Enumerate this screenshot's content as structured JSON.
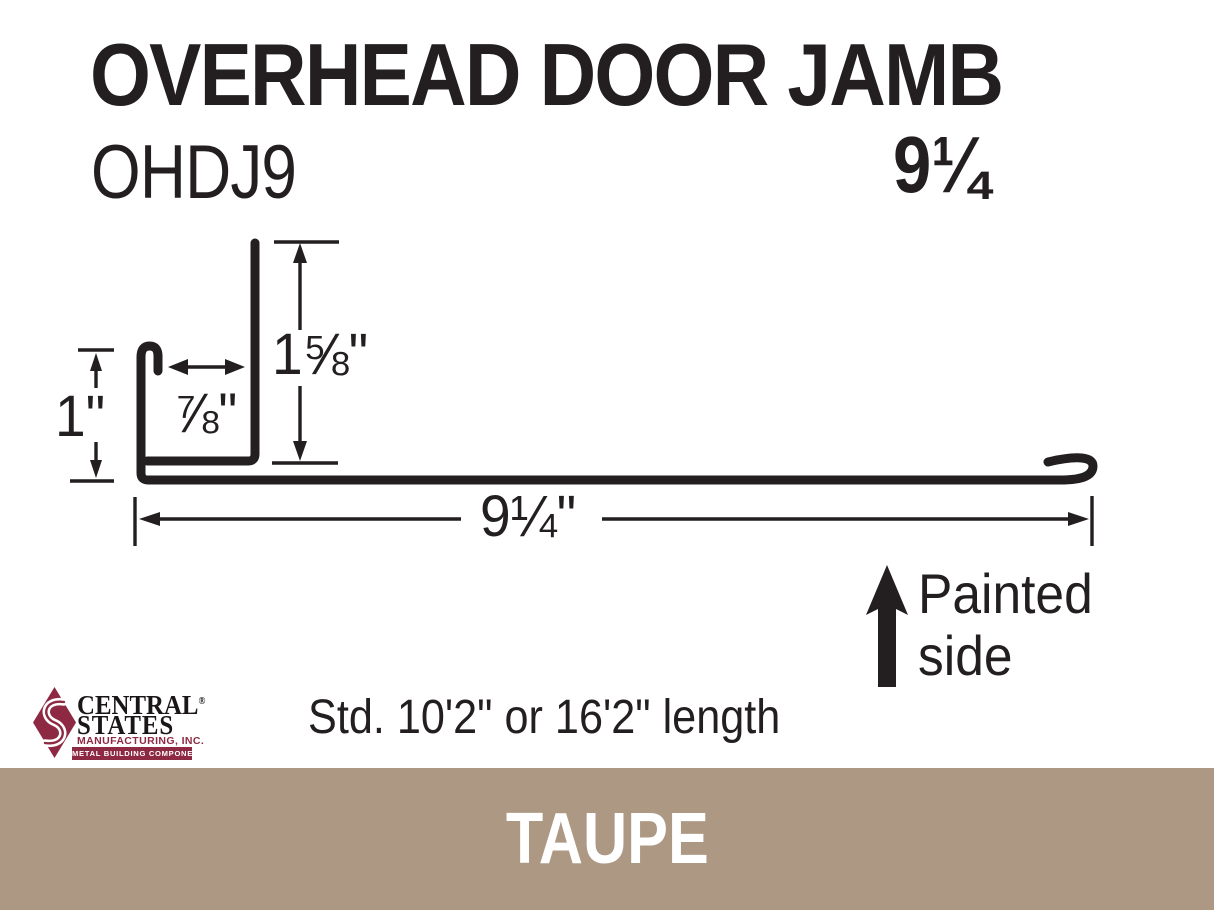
{
  "colors": {
    "ink": "#231F20",
    "paper": "#FFFFFF"
  },
  "header": {
    "title": "OVERHEAD DOOR JAMB",
    "model": "OHDJ9",
    "width_label": "9¼"
  },
  "diagram": {
    "dim_jamb_height": "1⅝\"",
    "dim_channel_width": "⅞\"",
    "dim_leg_height": "1\"",
    "dim_base_width": "9¼\"",
    "painted_word1": "Painted",
    "painted_word2": "side"
  },
  "notes": {
    "length": "Std. 10'2\" or 16'2\" length"
  },
  "logo": {
    "name_top": "CENTRAL",
    "registered": "®",
    "name_bottom": "STATES",
    "subtitle": "MANUFACTURING, INC.",
    "banner": "METAL BUILDING COMPONENTS",
    "brand_color": "#8E2943"
  },
  "color_band": {
    "label": "TAUPE",
    "color": "#AC9883"
  }
}
